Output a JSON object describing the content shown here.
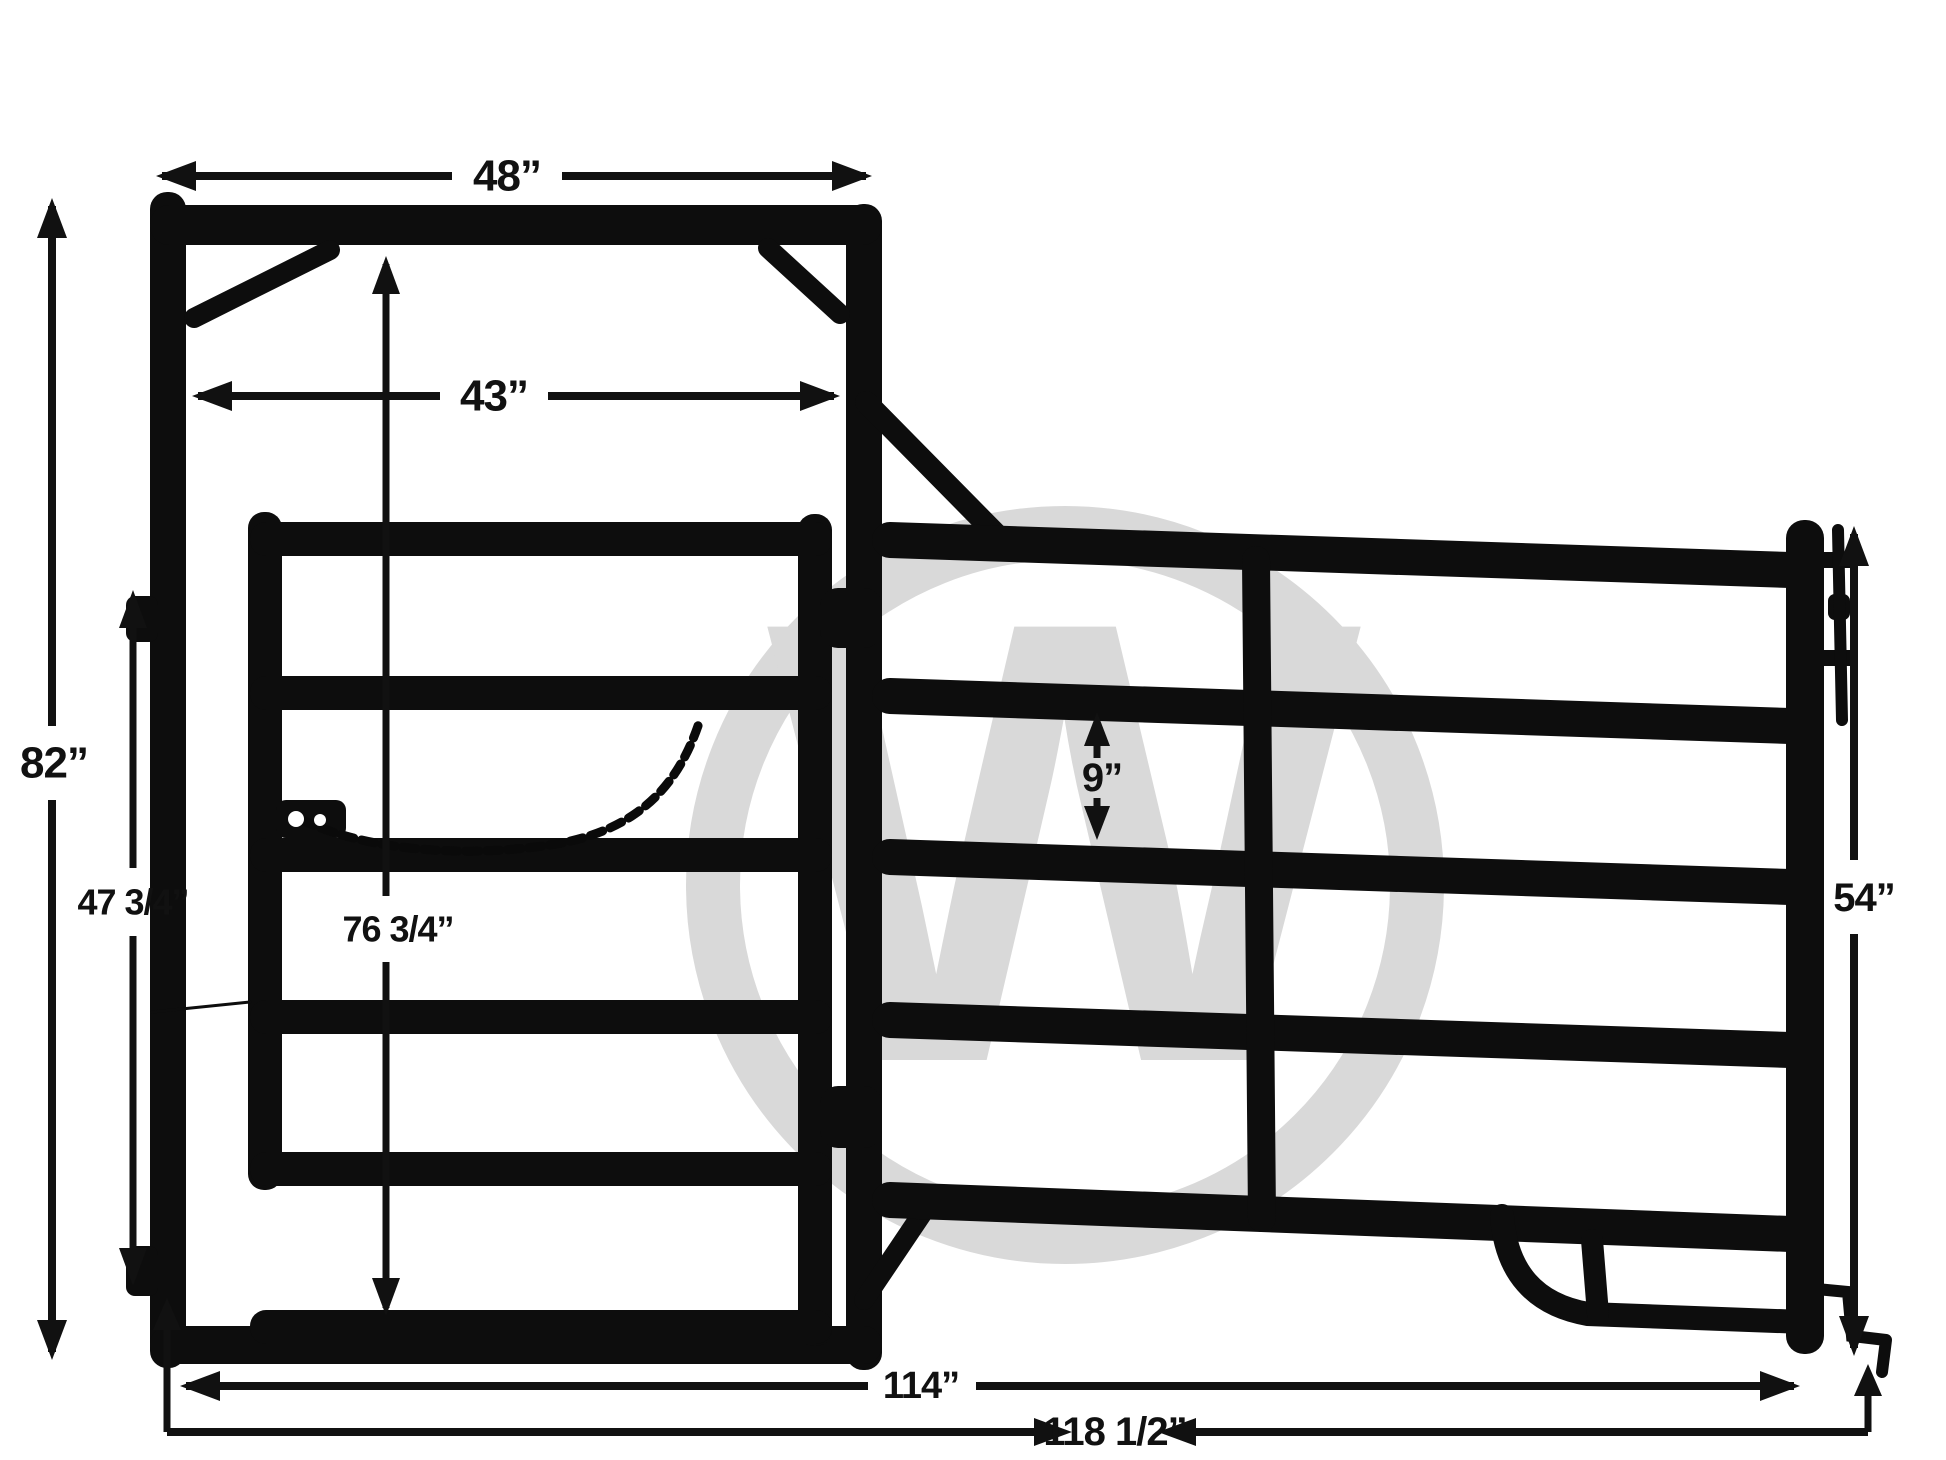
{
  "watermark": {
    "letter": "W"
  },
  "colors": {
    "steel": "#0d0d0d",
    "chain": "#0a0a0a",
    "dim": "#111111",
    "watermark": "#d9d9d9",
    "background": "#ffffff"
  },
  "dimensions": {
    "frame_width": {
      "label": "48”"
    },
    "opening_width": {
      "label": "43”"
    },
    "frame_height": {
      "label": "82”"
    },
    "hinge_spacing": {
      "label": "47 3/4”"
    },
    "opening_height": {
      "label": "76 3/4”"
    },
    "rail_spacing": {
      "label": "9”"
    },
    "panel_height": {
      "label": "54”"
    },
    "panel_length": {
      "label": "114”"
    },
    "overall_length": {
      "label": "118 1/2”"
    }
  }
}
